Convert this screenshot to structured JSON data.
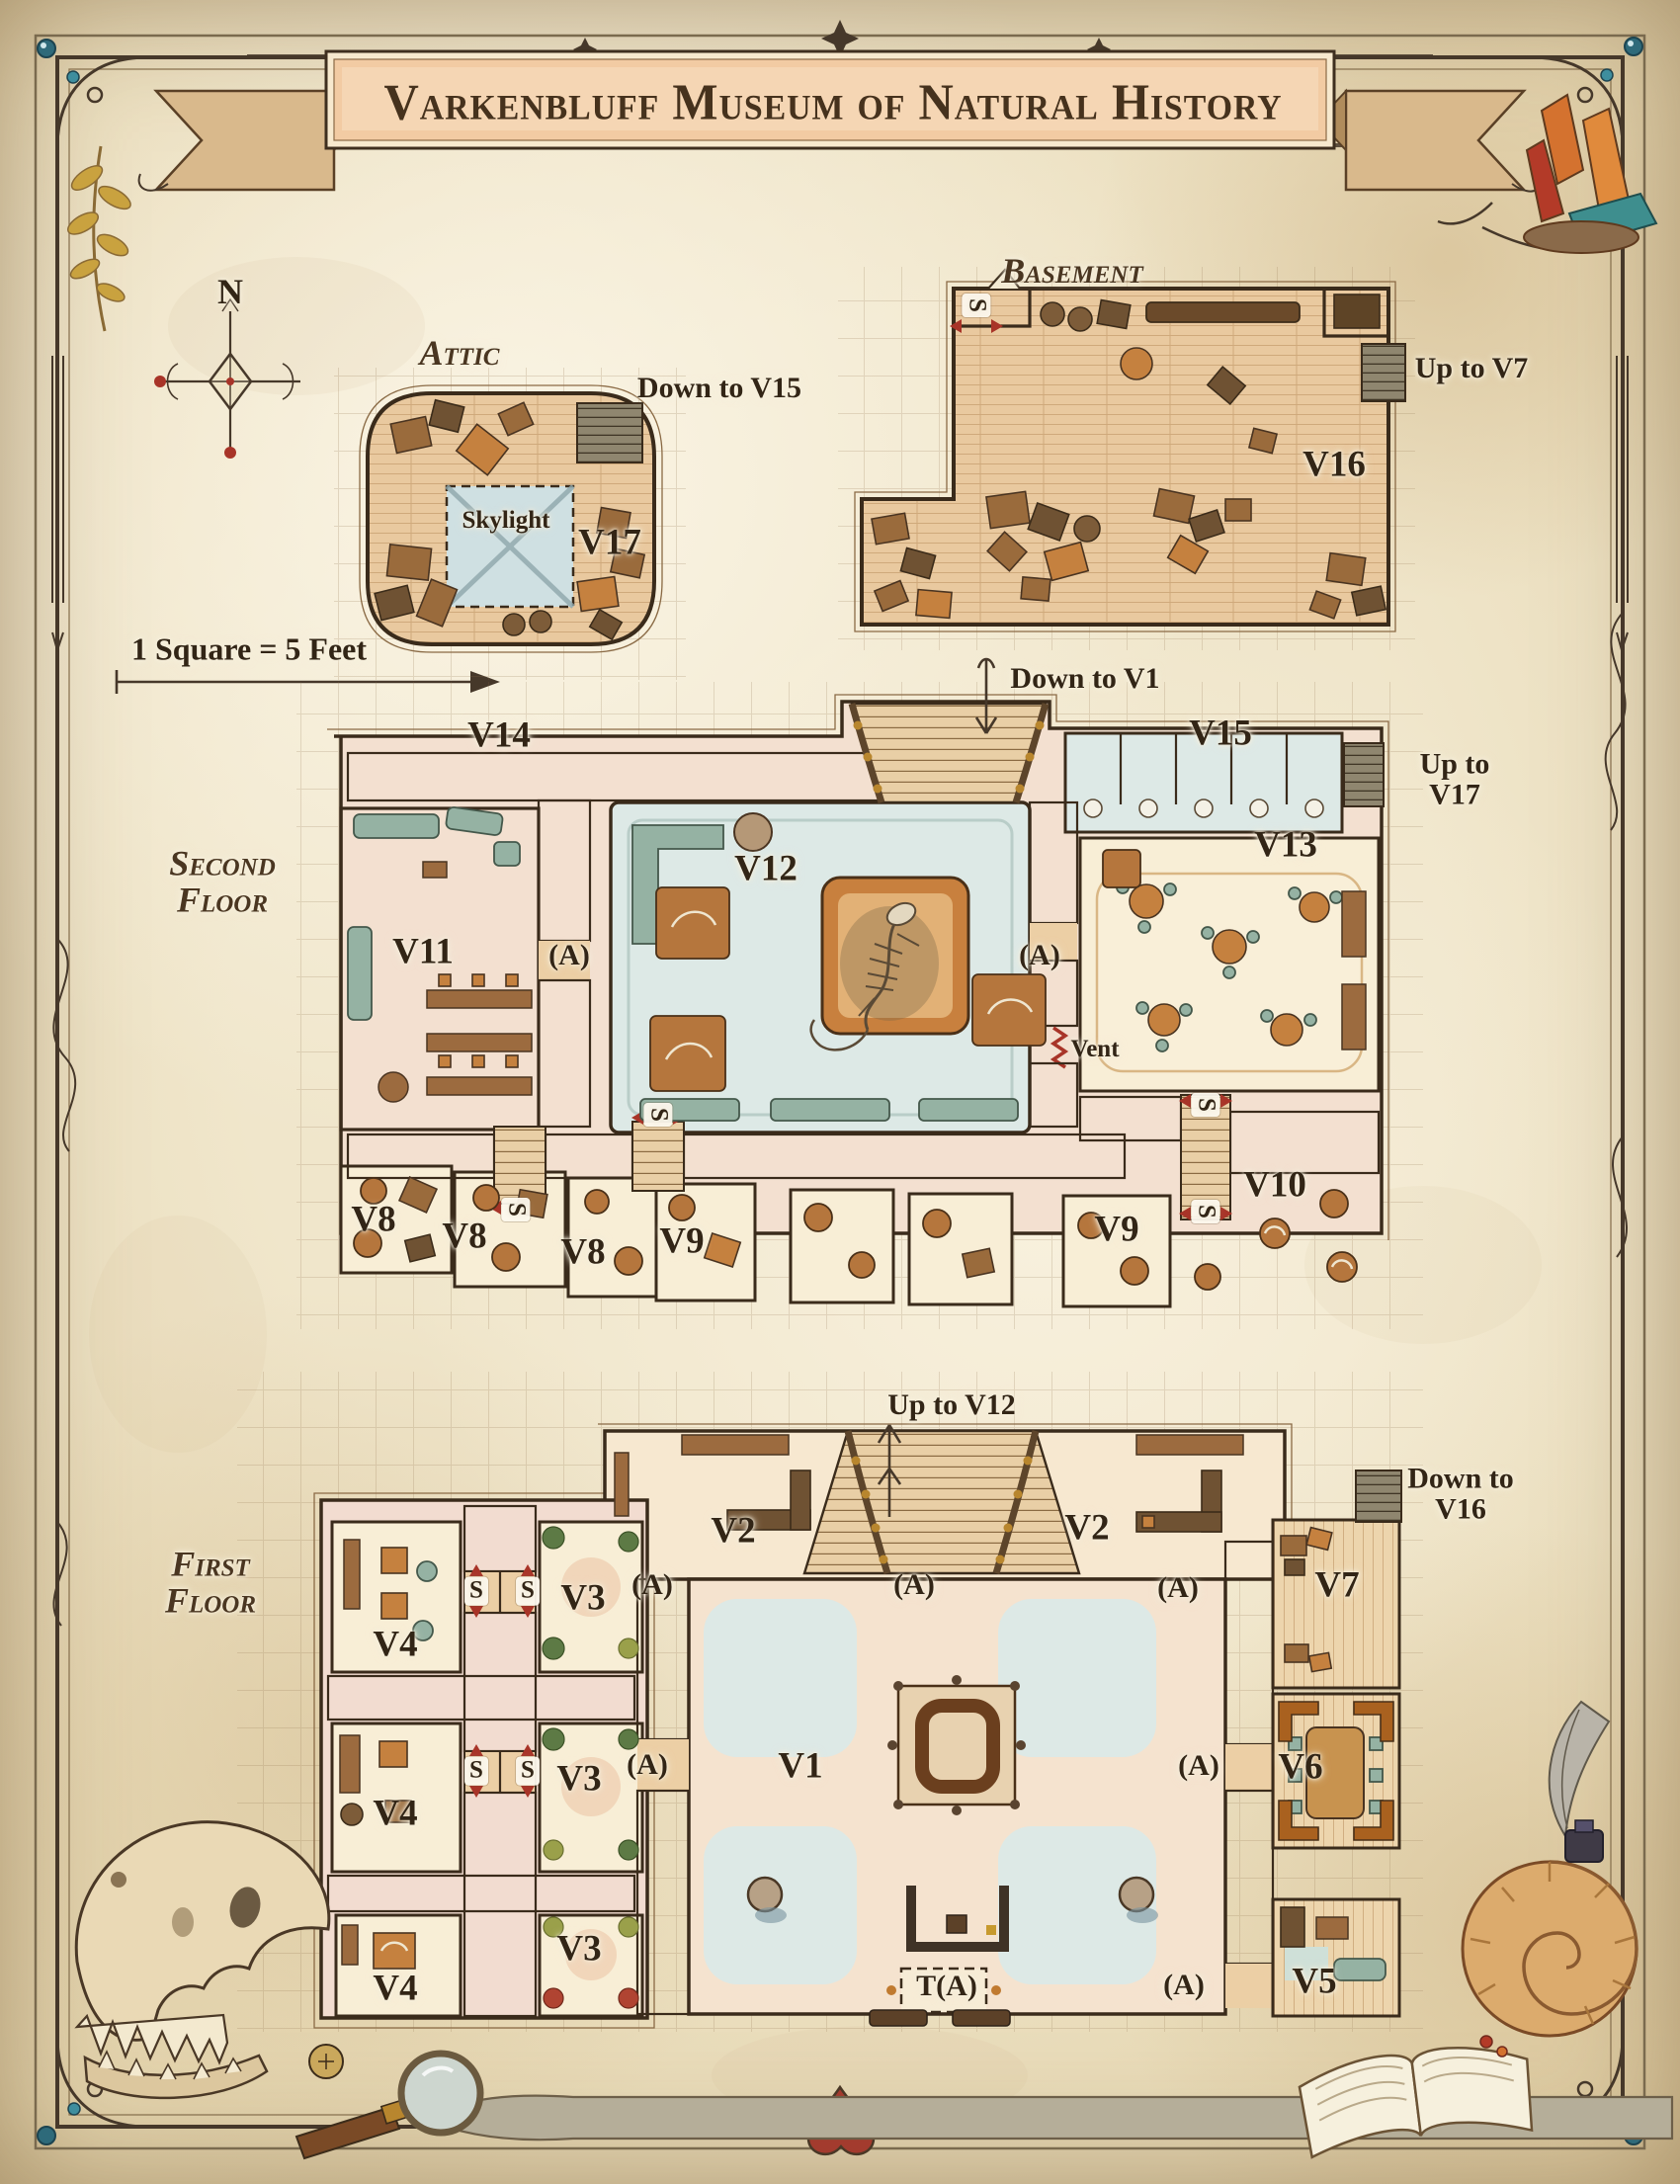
{
  "title": "Varkenbluff Museum of Natural History",
  "compass_n": "N",
  "scale_note": "1 Square = 5 Feet",
  "palette": {
    "parchment": "#ece0c2",
    "ink": "#3a2b1b",
    "banner": "#f2cba3",
    "red_marker": "#a83428",
    "water_blue": "#dde9e6",
    "wood": "#e8c99f"
  },
  "attic": {
    "name": "Attic",
    "stairs_down": "Down to V15",
    "skylight": "Skylight",
    "room": "V17"
  },
  "basement": {
    "name": "Basement",
    "room": "V16",
    "stairs_up": "Up to V7",
    "stair_marker": "S"
  },
  "second_floor": {
    "name": "Second Floor",
    "stairs_down": "Down to V1",
    "stairs_up": "Up to V17",
    "vent": "Vent",
    "rooms": {
      "v8a": "V8",
      "v8b": "V8",
      "v8c": "V8",
      "v9a": "V9",
      "v9b": "V9",
      "v10": "V10",
      "v11": "V11",
      "v12": "V12",
      "v13": "V13",
      "v14": "V14",
      "v15": "V15"
    },
    "markers": {
      "a_left": "(A)",
      "a_right": "(A)",
      "s1": "S",
      "s2": "S",
      "s3": "S",
      "s4": "S"
    }
  },
  "first_floor": {
    "name": "First Floor",
    "stairs_up": "Up to V12",
    "stairs_down": "Down to V16",
    "rooms": {
      "v1": "V1",
      "v2a": "V2",
      "v2b": "V2",
      "v3a": "V3",
      "v3b": "V3",
      "v3c": "V3",
      "v4a": "V4",
      "v4b": "V4",
      "v4c": "V4",
      "v5": "V5",
      "v6": "V6",
      "v7": "V7"
    },
    "markers": {
      "a1": "(A)",
      "a2": "(A)",
      "a3": "(A)",
      "a4": "(A)",
      "a5": "(A)",
      "a6": "(A)",
      "t_a": "T(A)",
      "s1": "S",
      "s2": "S",
      "s3": "S",
      "s4": "S"
    }
  }
}
